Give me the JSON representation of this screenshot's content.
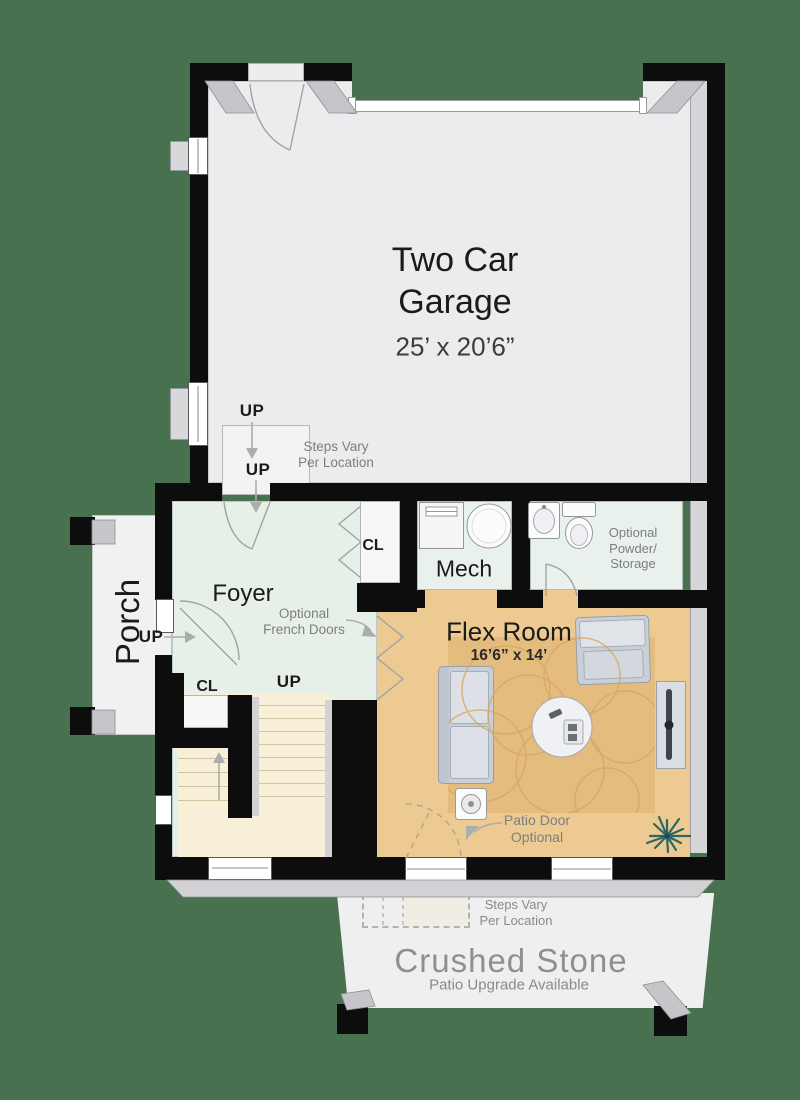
{
  "colors": {
    "bg": "#48714f",
    "wall": "#0d0d0d",
    "garage_floor": "#ececee",
    "foyer_floor": "#e7efe9",
    "wet_floor": "#e9f1ed",
    "flex_floor": "#ecca92",
    "rug": "#e4bc7e",
    "stair_floor": "#f7efd8",
    "porch_floor": "#f1f1f2",
    "stone_floor": "#efefef",
    "closet_floor": "#f7f7f8",
    "bevel": "#c6c6ca",
    "note": "#7e7e7e",
    "stone_text": "#8f8f8f"
  },
  "garage": {
    "name": "Two Car Garage",
    "dims": "25’ x 20’6”",
    "steps": {
      "up_top": "UP",
      "up_bottom": "UP",
      "note1": "Steps Vary",
      "note2": "Per Location"
    }
  },
  "foyer": {
    "name": "Foyer",
    "closet": "CL",
    "entry_up": "UP",
    "french_note1": "Optional",
    "french_note2": "French Doors"
  },
  "mech": {
    "name": "Mech"
  },
  "powder": {
    "note1": "Optional",
    "note2": "Powder/",
    "note3": "Storage"
  },
  "flex": {
    "name": "Flex Room",
    "dims": "16’6” x 14’",
    "patio_note1": "Patio Door",
    "patio_note2": "Optional"
  },
  "stairs": {
    "up": "UP",
    "closet": "CL"
  },
  "porch": {
    "name": "Porch"
  },
  "stone": {
    "name": "Crushed Stone",
    "sub": "Patio Upgrade Available",
    "note1": "Steps Vary",
    "note2": "Per Location"
  }
}
